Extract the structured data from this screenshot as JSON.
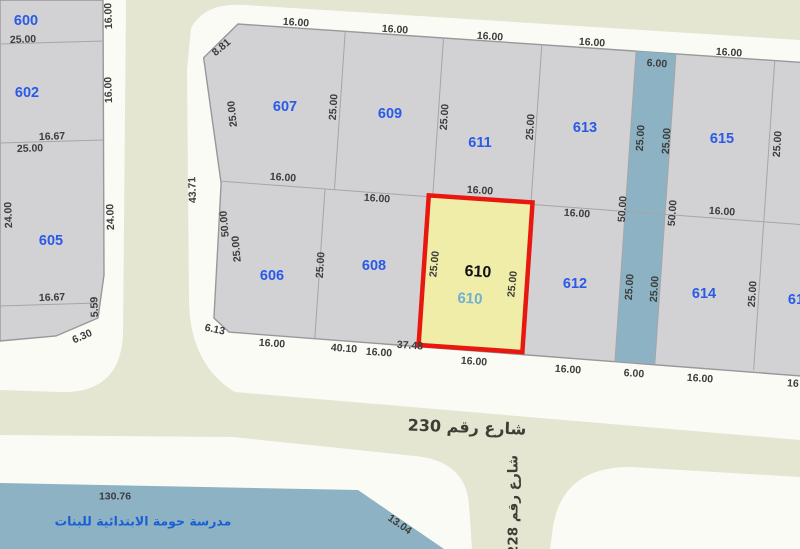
{
  "map_title": "cadastral-parcel-map",
  "colors": {
    "background": "#fbfbf5",
    "street": "#e4e6d1",
    "block_fill": "#d2d2d4",
    "block_border": "#98989a",
    "inner_line": "#a6a6a8",
    "water": "#8cb2c3",
    "highlight_fill": "#f0eda8",
    "highlight_border": "#e8170f",
    "plot_number": "#2a5ae6",
    "dimension_text": "#3c3c3c",
    "street_text": "#3e3e36",
    "school_text": "#1b5fd6",
    "highlight_sub": "#6fb0d4"
  },
  "highlight": {
    "number": "610",
    "number_secondary": "610"
  },
  "streets": {
    "street_230": "شارع رقم 230",
    "street_228": "شارع رقم 228"
  },
  "school": {
    "name": "مدرسة حومة الابتدائية للبنات"
  },
  "plot_labels": [
    {
      "t": "600",
      "x": 26,
      "y": 20
    },
    {
      "t": "602",
      "x": 27,
      "y": 92
    },
    {
      "t": "605",
      "x": 51,
      "y": 240
    },
    {
      "t": "607",
      "x": 285,
      "y": 106
    },
    {
      "t": "609",
      "x": 390,
      "y": 113
    },
    {
      "t": "611",
      "x": 480,
      "y": 142
    },
    {
      "t": "613",
      "x": 585,
      "y": 127
    },
    {
      "t": "615",
      "x": 722,
      "y": 138
    },
    {
      "t": "606",
      "x": 272,
      "y": 275
    },
    {
      "t": "608",
      "x": 374,
      "y": 265
    },
    {
      "t": "612",
      "x": 575,
      "y": 283
    },
    {
      "t": "614",
      "x": 704,
      "y": 293
    },
    {
      "t": "61",
      "x": 796,
      "y": 299
    }
  ],
  "dimension_labels": [
    {
      "t": "25.00",
      "x": 23,
      "y": 39,
      "r": -2
    },
    {
      "t": "16.00",
      "x": 108,
      "y": 16,
      "r": -92
    },
    {
      "t": "16.00",
      "x": 108,
      "y": 90,
      "r": -92
    },
    {
      "t": "16.67",
      "x": 52,
      "y": 136,
      "r": -2
    },
    {
      "t": "25.00",
      "x": 30,
      "y": 148,
      "r": -2
    },
    {
      "t": "24.00",
      "x": 8,
      "y": 215,
      "r": -92
    },
    {
      "t": "24.00",
      "x": 110,
      "y": 217,
      "r": -92
    },
    {
      "t": "16.67",
      "x": 52,
      "y": 297,
      "r": -2
    },
    {
      "t": "5.59",
      "x": 94,
      "y": 307,
      "r": -92
    },
    {
      "t": "6.30",
      "x": 82,
      "y": 336,
      "r": -24
    },
    {
      "t": "43.71",
      "x": 192,
      "y": 190,
      "r": -92
    },
    {
      "t": "8.81",
      "x": 221,
      "y": 47,
      "r": -40
    },
    {
      "t": "16.00",
      "x": 296,
      "y": 22,
      "r": 4
    },
    {
      "t": "25.00",
      "x": 232,
      "y": 114,
      "r": -96
    },
    {
      "t": "25.00",
      "x": 333,
      "y": 107,
      "r": -86
    },
    {
      "t": "16.00",
      "x": 395,
      "y": 29,
      "r": 4
    },
    {
      "t": "25.00",
      "x": 444,
      "y": 117,
      "r": -86
    },
    {
      "t": "16.00",
      "x": 490,
      "y": 36,
      "r": 4
    },
    {
      "t": "25.00",
      "x": 530,
      "y": 127,
      "r": -86
    },
    {
      "t": "16.00",
      "x": 592,
      "y": 42,
      "r": 4
    },
    {
      "t": "25.00",
      "x": 640,
      "y": 138,
      "r": -86
    },
    {
      "t": "6.00",
      "x": 657,
      "y": 63,
      "r": 4
    },
    {
      "t": "25.00",
      "x": 666,
      "y": 141,
      "r": -86
    },
    {
      "t": "16.00",
      "x": 729,
      "y": 52,
      "r": 4
    },
    {
      "t": "25.00",
      "x": 777,
      "y": 144,
      "r": -86
    },
    {
      "t": "16.00",
      "x": 283,
      "y": 177,
      "r": 4
    },
    {
      "t": "16.00",
      "x": 377,
      "y": 198,
      "r": 4
    },
    {
      "t": "16.00",
      "x": 480,
      "y": 190,
      "r": 4
    },
    {
      "t": "16.00",
      "x": 577,
      "y": 213,
      "r": 4
    },
    {
      "t": "50.00",
      "x": 622,
      "y": 209,
      "r": -86
    },
    {
      "t": "50.00",
      "x": 672,
      "y": 213,
      "r": -86
    },
    {
      "t": "16.00",
      "x": 722,
      "y": 211,
      "r": 4
    },
    {
      "t": "50.00",
      "x": 224,
      "y": 224,
      "r": -95
    },
    {
      "t": "25.00",
      "x": 236,
      "y": 249,
      "r": -95
    },
    {
      "t": "25.00",
      "x": 320,
      "y": 265,
      "r": -86
    },
    {
      "t": "25.00",
      "x": 434,
      "y": 264,
      "r": -84
    },
    {
      "t": "25.00",
      "x": 512,
      "y": 284,
      "r": -84
    },
    {
      "t": "25.00",
      "x": 629,
      "y": 287,
      "r": -86
    },
    {
      "t": "25.00",
      "x": 654,
      "y": 289,
      "r": -86
    },
    {
      "t": "25.00",
      "x": 752,
      "y": 294,
      "r": -86
    },
    {
      "t": "6.13",
      "x": 215,
      "y": 329,
      "r": 12
    },
    {
      "t": "16.00",
      "x": 272,
      "y": 343,
      "r": 4
    },
    {
      "t": "40.10",
      "x": 344,
      "y": 348,
      "r": 4
    },
    {
      "t": "16.00",
      "x": 379,
      "y": 352,
      "r": 4
    },
    {
      "t": "37.48",
      "x": 410,
      "y": 345,
      "r": 4
    },
    {
      "t": "16.00",
      "x": 474,
      "y": 361,
      "r": 4
    },
    {
      "t": "16.00",
      "x": 568,
      "y": 369,
      "r": 4
    },
    {
      "t": "6.00",
      "x": 634,
      "y": 373,
      "r": 4
    },
    {
      "t": "16.00",
      "x": 700,
      "y": 378,
      "r": 4
    },
    {
      "t": "16",
      "x": 793,
      "y": 383,
      "r": 4
    },
    {
      "t": "130.76",
      "x": 115,
      "y": 496,
      "r": 0
    },
    {
      "t": "13.04",
      "x": 400,
      "y": 524,
      "r": 35
    }
  ]
}
